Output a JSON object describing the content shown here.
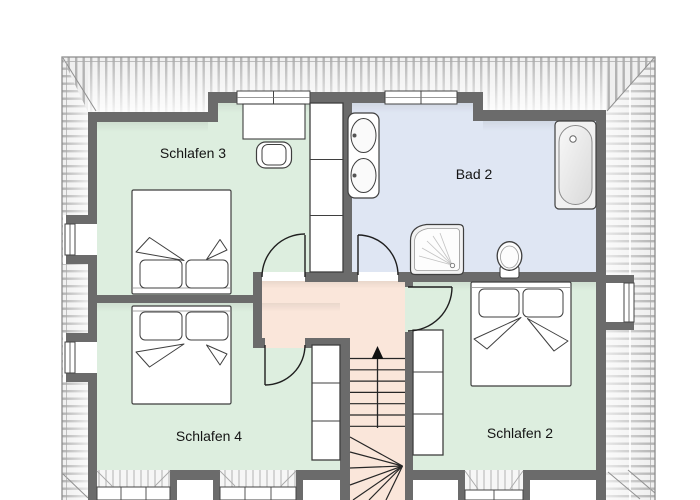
{
  "plan": {
    "type": "attic-floor-plan",
    "stairs_direction": "up"
  },
  "rooms": {
    "schlafen3": {
      "label": "Schlafen 3"
    },
    "bad2": {
      "label": "Bad 2"
    },
    "schlafen4": {
      "label": "Schlafen 4"
    },
    "schlafen2": {
      "label": "Schlafen 2"
    }
  },
  "fixtures": {
    "bedrooms": [
      "double-bed",
      "wardrobe",
      "desk",
      "chair"
    ],
    "bathroom": [
      "double-washbasin",
      "bathtub",
      "shower",
      "toilet"
    ],
    "circulation": [
      "staircase-up",
      "hallway",
      "four-doors"
    ]
  },
  "colors": {
    "bedroom_fill": "#ddeedf",
    "bathroom_fill": "#dfe6f3",
    "hallway_fill": "#fae6da",
    "wall": "#6b6b6b",
    "hatch_stripe": "#b3b3b3",
    "hatch_bg": "#efefef",
    "outline": "#8c8c8c",
    "fixture_line": "#3f3f3f"
  }
}
